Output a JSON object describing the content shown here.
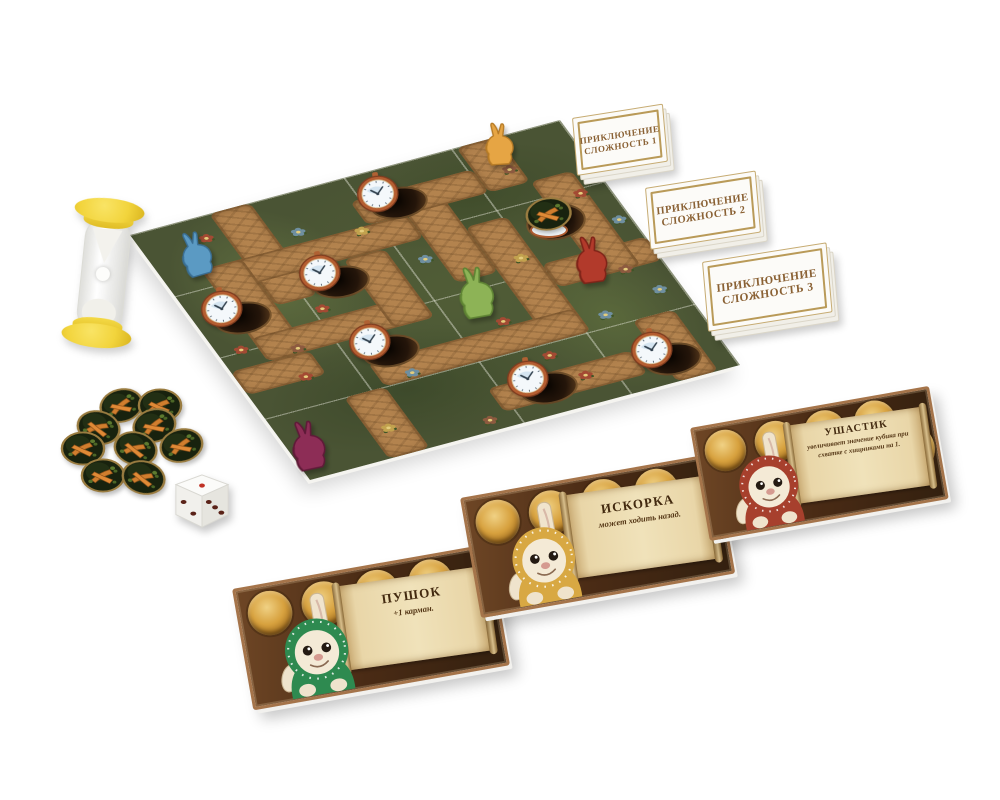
{
  "adventure_decks": [
    {
      "line1": "ПРИКЛЮЧЕНИЕ",
      "line2": "СЛОЖНОСТЬ 1"
    },
    {
      "line1": "ПРИКЛЮЧЕНИЕ",
      "line2": "СЛОЖНОСТЬ 2"
    },
    {
      "line1": "ПРИКЛЮЧЕНИЕ",
      "line2": "СЛОЖНОСТЬ 3"
    }
  ],
  "character_cards": [
    {
      "name": "ПУШОК",
      "ability": "+1 карман.",
      "hood_hex": "#2e8a50"
    },
    {
      "name": "ИСКОРКА",
      "ability": "может ходить назад.",
      "hood_hex": "#d8a843"
    },
    {
      "name": "УШАСТИК",
      "ability": "увеличивает значение кубика при схватке с хищниками на 1.",
      "hood_hex": "#a7402d"
    }
  ],
  "board": {
    "meeples": [
      {
        "color_name": "blue",
        "hex": "#5b9ac3",
        "edge_hex": "#3a6e93"
      },
      {
        "color_name": "orange",
        "hex": "#e6a544",
        "edge_hex": "#b57a26"
      },
      {
        "color_name": "red",
        "hex": "#b23a2b",
        "edge_hex": "#7e2418"
      },
      {
        "color_name": "green",
        "hex": "#8db356",
        "edge_hex": "#5f8434"
      },
      {
        "color_name": "purple",
        "hex": "#8d2d56",
        "edge_hex": "#5f1a38"
      }
    ],
    "clock_token_count": 6,
    "burrow_hole_count": 7,
    "carrot_tokens_on_board": 1
  },
  "loose_components": {
    "carrot_token_pile_count": 9,
    "die": {
      "top_face_pips": 1,
      "left_face_pips": 2,
      "right_face_pips": 3,
      "top_pip_hex": "#c03125",
      "side_pip_hex": "#5a2218"
    },
    "sand_timer": {
      "cap_hex": "#f2d43c",
      "sand_hex": "#ffffff"
    }
  },
  "palette": {
    "background": "#ffffff",
    "deck_frame_gold": "#b99a58",
    "deck_text_brown": "#8a6134",
    "card_frame_tan": "#a5744a",
    "card_bg_brown": "#4a2b15",
    "pocket_gold": "#d7a13e",
    "parchment": "#f0e2ba",
    "board_green": "#4a5434",
    "path_brown": "#b3834e",
    "clock_rim_copper": "#b55e31",
    "carrot_orange": "#d9802f"
  }
}
